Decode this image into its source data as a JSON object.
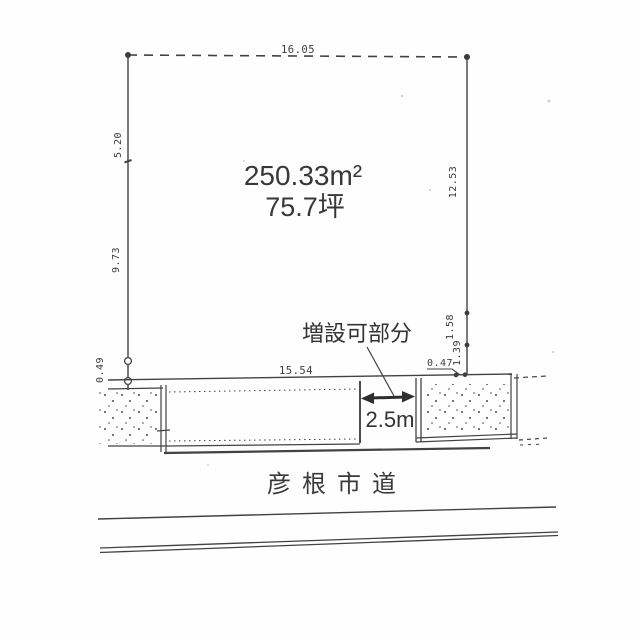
{
  "page": {
    "paper_color": "#fefefe",
    "ink_color": "#424242"
  },
  "plot": {
    "area_m2": "250.33m²",
    "area_tsubo": "75.7坪",
    "dim_top": "16.05",
    "dim_left_upper": "5.20",
    "dim_left_lower": "9.73",
    "dim_left_bottom": "0.49",
    "dim_right_upper": "12.53",
    "dim_right_mid": "1.58",
    "dim_right_lower": "1.39",
    "dim_right_bottom": "0.47",
    "dim_frontage": "15.54"
  },
  "annotation": {
    "expandable_label": "増設可部分",
    "expandable_width": "2.5m"
  },
  "road": {
    "name": "彦根市道"
  }
}
